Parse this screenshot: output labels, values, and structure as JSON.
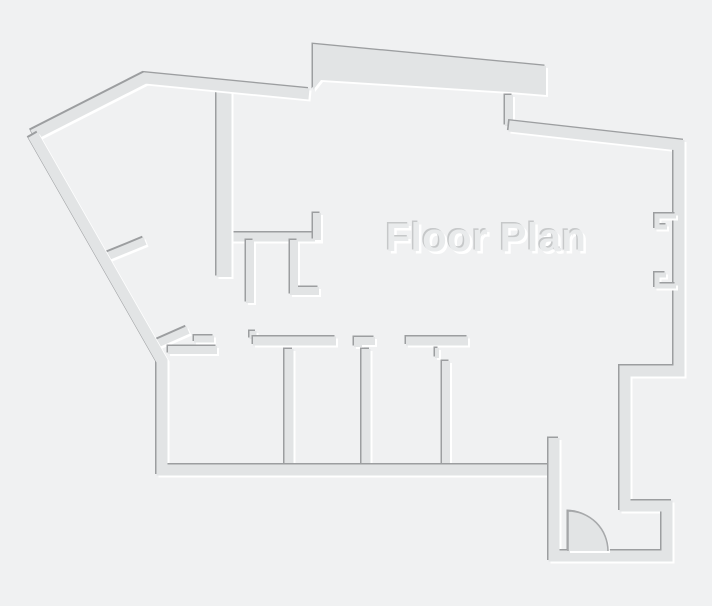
{
  "page": {
    "background": "#f0f1f2"
  },
  "plan": {
    "title": "Floor Plan",
    "colors": {
      "background": "#f0f1f2",
      "wall_fill": "#e2e4e5",
      "edge_dark": "#9c9ea0",
      "edge_light": "#ffffff",
      "title_fill": "#e9ebec",
      "title_shadow": "#c6c8c9",
      "door_stroke": "#a7a9ab"
    },
    "canvas": {
      "width": 712,
      "height": 606
    },
    "title_pos": {
      "x": 486,
      "y": 251
    },
    "walls": [
      {
        "name": "kitchen-counter-wall",
        "type": "polyline",
        "points": "226,237 321,237",
        "width": 9
      },
      {
        "name": "kitchen-stub-up",
        "type": "polyline",
        "points": "317,240 317,213",
        "width": 8
      },
      {
        "name": "kitchen-stub-left",
        "type": "polyline",
        "points": "250,240 250,303",
        "width": 8
      },
      {
        "name": "kitchen-stub-right",
        "type": "polyline",
        "points": "294,240 294,291 319,291",
        "width": 8
      },
      {
        "name": "hall-wall",
        "type": "polyline",
        "points": "224,87 224,277",
        "width": 15
      },
      {
        "name": "west-partition-upper",
        "type": "polyline",
        "points": "101,259 145,241",
        "width": 8
      },
      {
        "name": "west-partition-lower",
        "type": "polyline",
        "points": "154,345 188,330",
        "width": 8
      },
      {
        "name": "door-jamb-bar",
        "type": "polyline",
        "points": "194,339 214,339",
        "width": 7
      },
      {
        "name": "room1-top-wall",
        "type": "polyline",
        "points": "168,350 217,350",
        "width": 8
      },
      {
        "name": "room2-header-tab",
        "type": "polyline",
        "points": "253,331 253,339",
        "width": 7
      },
      {
        "name": "room2-header",
        "type": "polyline",
        "points": "253,341 336,341",
        "width": 9
      },
      {
        "name": "room3-header-step",
        "type": "polyline",
        "points": "358,347 358,341 375,341",
        "width": 8
      },
      {
        "name": "room-divider-2",
        "type": "polyline",
        "points": "366,349 366,466",
        "width": 9
      },
      {
        "name": "room4-header",
        "type": "polyline",
        "points": "406,341 468,341",
        "width": 9
      },
      {
        "name": "divider-3-jamb",
        "type": "polyline",
        "points": "437,348 437,358",
        "width": 4
      },
      {
        "name": "room-divider-3",
        "type": "polyline",
        "points": "446,361 446,466",
        "width": 8
      },
      {
        "name": "room-divider-1",
        "type": "polyline",
        "points": "289,349 289,466",
        "width": 9
      },
      {
        "name": "outline-northwest",
        "type": "polyline",
        "points": "33,135 145,78 309,94",
        "width": 11
      },
      {
        "name": "outline-west-south",
        "type": "polyline",
        "points": "33,135 162,361 162,470 556,470",
        "width": 11
      },
      {
        "name": "north-band",
        "type": "polygon",
        "points": "313,44 546,66 546,95 509,92 321,80 313,90"
      },
      {
        "name": "north-step",
        "type": "polyline",
        "points": "509,95 509,126",
        "width": 8
      },
      {
        "name": "outline-east",
        "type": "polyline",
        "points": "509,126 679,145 679,371 625,371 625,506 667,506 667,556 554,556 554,438",
        "width": 11
      },
      {
        "name": "east-niche-upper",
        "type": "polyline",
        "points": "676,216 657,216 657,227 667,227",
        "width": 5
      },
      {
        "name": "east-niche-lower",
        "type": "polyline",
        "points": "666,275 657,275 657,286 676,286",
        "width": 5
      }
    ],
    "door": {
      "hinge_x": 568,
      "hinge_y": 551,
      "radius": 40
    }
  }
}
